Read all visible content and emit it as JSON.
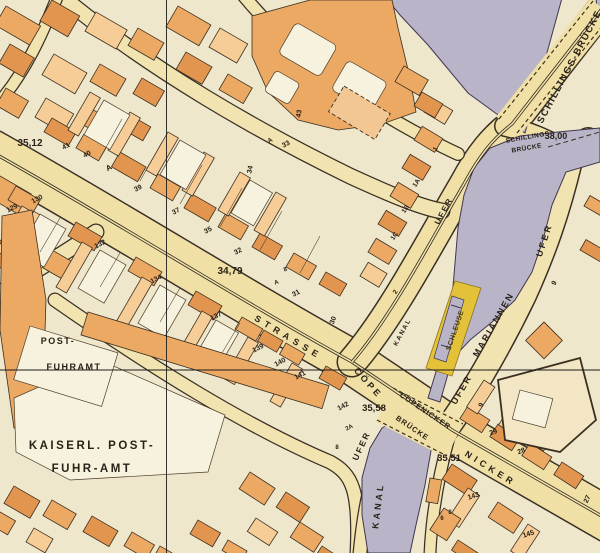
{
  "map_type": "historical-city-map-scan",
  "palette": {
    "paper": "#efe7cc",
    "street": "#f1e0a5",
    "building_dark": "#e2954e",
    "building_mid": "#eca964",
    "building_light": "#f6cc97",
    "courtyard": "#f7f2de",
    "water": "#b9b4c7",
    "lock_highlight": "#e3c139",
    "ink": "#2a2118"
  },
  "features": {
    "river": "Spree",
    "bridges": [
      "Schillings-Brücke",
      "Cöpenicker Brücke"
    ],
    "streets": [
      "Cöpenicker Strasse",
      "Mariannen Ufer",
      "Ufer"
    ],
    "waterways": [
      "Kanal",
      "Schleuse"
    ],
    "landmarks": [
      "Kaiserl. Post-Fuhr-Amt",
      "Post-Fuhramt"
    ],
    "elevations": [
      "35,12",
      "34,79",
      "38,00",
      "35,58",
      "35,51"
    ]
  },
  "labels": [
    {
      "text": "SCHILLINGS-BRÜCKE",
      "x": 572,
      "y": 68,
      "rot": -62,
      "size": 9.5,
      "sp": 1.5
    },
    {
      "text": "SCHILLINGS",
      "x": 528,
      "y": 139,
      "rot": -10,
      "size": 6.5,
      "sp": 0.5
    },
    {
      "text": "BRÜCKE",
      "x": 527,
      "y": 150,
      "rot": -10,
      "size": 6.5,
      "sp": 0.5
    },
    {
      "text": "38,00",
      "x": 556,
      "y": 139,
      "rot": 0,
      "size": 9,
      "bold": true
    },
    {
      "text": "UFER",
      "x": 446,
      "y": 212,
      "rot": -62,
      "size": 8,
      "sp": 2
    },
    {
      "text": "KANAL",
      "x": 404,
      "y": 333,
      "rot": -62,
      "size": 6.5,
      "sp": 1.5
    },
    {
      "text": "SCHLEUSE",
      "x": 457,
      "y": 331,
      "rot": -71,
      "size": 7,
      "sp": 0.5,
      "cls": "lock"
    },
    {
      "text": "UFER",
      "x": 547,
      "y": 241,
      "rot": -72,
      "size": 9,
      "sp": 2.5
    },
    {
      "text": "MARIANNEN",
      "x": 496,
      "y": 326,
      "rot": -60,
      "size": 9,
      "sp": 2
    },
    {
      "text": "UFER",
      "x": 464,
      "y": 391,
      "rot": -60,
      "size": 9,
      "sp": 2
    },
    {
      "text": "9",
      "x": 556,
      "y": 284,
      "rot": -60,
      "size": 7
    },
    {
      "text": "9",
      "x": 483,
      "y": 406,
      "rot": -60,
      "size": 7
    },
    {
      "text": "STRASSE",
      "x": 287,
      "y": 340,
      "rot": 31,
      "size": 9,
      "sp": 5
    },
    {
      "text": "CÖPE",
      "x": 366,
      "y": 385,
      "rot": 48,
      "size": 9,
      "sp": 3
    },
    {
      "text": "NICKER",
      "x": 489,
      "y": 471,
      "rot": 32,
      "size": 9,
      "sp": 4
    },
    {
      "text": "CÖPENICKER",
      "x": 424,
      "y": 413,
      "rot": 34,
      "size": 7.5,
      "sp": 1
    },
    {
      "text": "BRÜCKE",
      "x": 411,
      "y": 430,
      "rot": 34,
      "size": 7.5,
      "sp": 1
    },
    {
      "text": "35,58",
      "x": 374,
      "y": 411,
      "rot": 0,
      "size": 9.5,
      "bold": true
    },
    {
      "text": "35,51",
      "x": 449,
      "y": 461,
      "rot": 0,
      "size": 9.5,
      "bold": true
    },
    {
      "text": "35,12",
      "x": 30,
      "y": 146,
      "rot": 0,
      "size": 10,
      "bold": true
    },
    {
      "text": "34,79",
      "x": 230,
      "y": 274,
      "rot": 0,
      "size": 10,
      "bold": true
    },
    {
      "text": "UFER",
      "x": 364,
      "y": 447,
      "rot": -65,
      "size": 8.5,
      "sp": 2
    },
    {
      "text": "KANAL",
      "x": 381,
      "y": 506,
      "rot": -83,
      "size": 9,
      "sp": 3
    },
    {
      "text": "POST-",
      "x": 58,
      "y": 344,
      "rot": 0,
      "size": 9,
      "sp": 1.5
    },
    {
      "text": "FUHRAMT",
      "x": 74,
      "y": 370,
      "rot": 0,
      "size": 9,
      "sp": 1.5
    },
    {
      "text": "KAISERL. POST-",
      "x": 92,
      "y": 449,
      "rot": 0,
      "size": 11.5,
      "sp": 2.5
    },
    {
      "text": "FUHR-AMT",
      "x": 92,
      "y": 472,
      "rot": 0,
      "size": 11.5,
      "sp": 2.5
    },
    {
      "text": "41",
      "x": 67,
      "y": 148,
      "rot": -28,
      "size": 7
    },
    {
      "text": "40",
      "x": 88,
      "y": 156,
      "rot": -28,
      "size": 7
    },
    {
      "text": "A",
      "x": 110,
      "y": 170,
      "rot": -28,
      "size": 8
    },
    {
      "text": "39",
      "x": 139,
      "y": 190,
      "rot": -28,
      "size": 7
    },
    {
      "text": "37",
      "x": 177,
      "y": 213,
      "rot": -28,
      "size": 7
    },
    {
      "text": "35",
      "x": 209,
      "y": 232,
      "rot": -28,
      "size": 7
    },
    {
      "text": "34",
      "x": 252,
      "y": 170,
      "rot": -78,
      "size": 7
    },
    {
      "text": "33",
      "x": 287,
      "y": 146,
      "rot": -28,
      "size": 7
    },
    {
      "text": "A",
      "x": 271,
      "y": 142,
      "rot": -28,
      "size": 6.5
    },
    {
      "text": "43",
      "x": 301,
      "y": 114,
      "rot": -80,
      "size": 7
    },
    {
      "text": "32",
      "x": 239,
      "y": 253,
      "rot": -28,
      "size": 7
    },
    {
      "text": "8",
      "x": 286,
      "y": 271,
      "rot": -20,
      "size": 6
    },
    {
      "text": "A",
      "x": 277,
      "y": 284,
      "rot": -20,
      "size": 6
    },
    {
      "text": "31",
      "x": 297,
      "y": 295,
      "rot": -28,
      "size": 7
    },
    {
      "text": "30",
      "x": 335,
      "y": 321,
      "rot": -70,
      "size": 7
    },
    {
      "text": "2",
      "x": 397,
      "y": 293,
      "rot": -58,
      "size": 6.5
    },
    {
      "text": "1C",
      "x": 396,
      "y": 237,
      "rot": -58,
      "size": 6.5
    },
    {
      "text": "1B",
      "x": 407,
      "y": 210,
      "rot": -58,
      "size": 6.5
    },
    {
      "text": "1A",
      "x": 418,
      "y": 184,
      "rot": -58,
      "size": 6.5
    },
    {
      "text": "1",
      "x": 437,
      "y": 150,
      "rot": -58,
      "size": 6.5
    },
    {
      "text": "29",
      "x": 494,
      "y": 434,
      "rot": -20,
      "size": 7
    },
    {
      "text": "28",
      "x": 522,
      "y": 453,
      "rot": -20,
      "size": 7
    },
    {
      "text": "27",
      "x": 589,
      "y": 500,
      "rot": -65,
      "size": 7
    },
    {
      "text": "129",
      "x": 13,
      "y": 210,
      "rot": -28,
      "size": 7
    },
    {
      "text": "130",
      "x": 38,
      "y": 201,
      "rot": -28,
      "size": 7
    },
    {
      "text": "132",
      "x": 101,
      "y": 246,
      "rot": -28,
      "size": 7
    },
    {
      "text": "134",
      "x": 157,
      "y": 281,
      "rot": -28,
      "size": 7
    },
    {
      "text": "137",
      "x": 217,
      "y": 318,
      "rot": -28,
      "size": 7
    },
    {
      "text": "139",
      "x": 259,
      "y": 350,
      "rot": -28,
      "size": 7
    },
    {
      "text": "140",
      "x": 281,
      "y": 364,
      "rot": -28,
      "size": 7
    },
    {
      "text": "141",
      "x": 301,
      "y": 377,
      "rot": -28,
      "size": 7
    },
    {
      "text": "142",
      "x": 344,
      "y": 408,
      "rot": -28,
      "size": 7
    },
    {
      "text": "2A",
      "x": 350,
      "y": 429,
      "rot": -28,
      "size": 6
    },
    {
      "text": "8",
      "x": 337,
      "y": 449,
      "rot": 0,
      "size": 6
    },
    {
      "text": "143",
      "x": 474,
      "y": 498,
      "rot": -18,
      "size": 7
    },
    {
      "text": "6",
      "x": 442,
      "y": 520,
      "rot": 0,
      "size": 6
    },
    {
      "text": "8",
      "x": 450,
      "y": 514,
      "rot": 0,
      "size": 6
    },
    {
      "text": "145",
      "x": 529,
      "y": 536,
      "rot": -18,
      "size": 7
    }
  ]
}
